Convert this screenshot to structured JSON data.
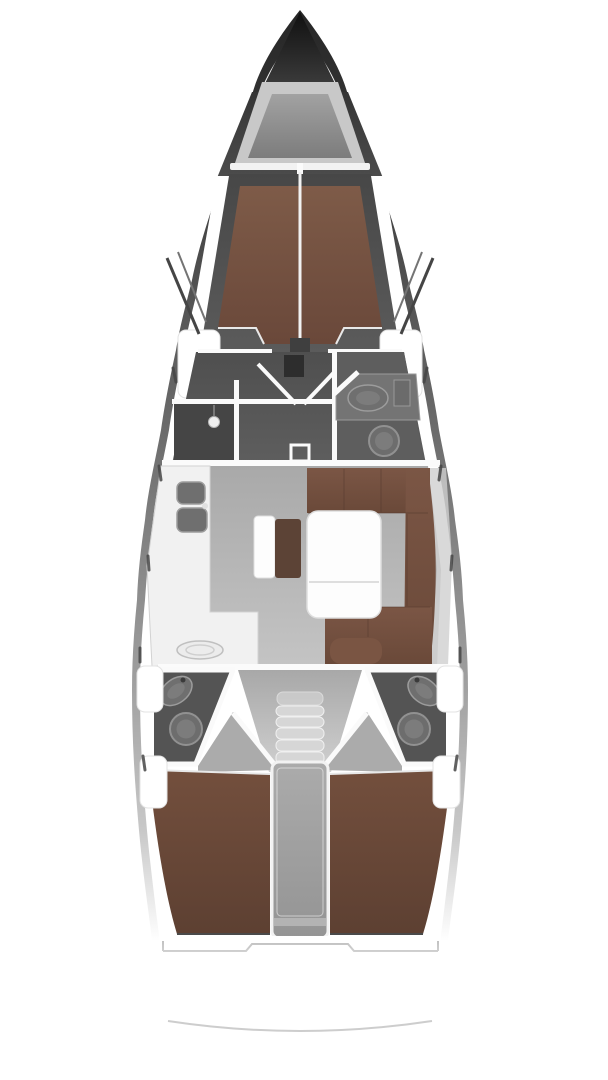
{
  "meta": {
    "title": "Sailing yacht interior layout plan",
    "view": "top-down deck plan",
    "canvas": {
      "width": 608,
      "height": 1080
    },
    "cabins_shown": 3,
    "wet_rooms_shown": 3
  },
  "regions": [
    {
      "id": "anchor-locker",
      "label": "Bow anchor locker"
    },
    {
      "id": "forward-cabin",
      "label": "Forward cabin with V-berth double bed"
    },
    {
      "id": "forward-shower",
      "label": "Forward shower compartment with shower head"
    },
    {
      "id": "forward-head",
      "label": "Forward head with vanity sink and toilet"
    },
    {
      "id": "mast-step",
      "label": "Mast step on centerline"
    },
    {
      "id": "passage-doors",
      "label": "Double doors between forward cabin and saloon"
    },
    {
      "id": "galley",
      "label": "Port galley with twin sinks and stove"
    },
    {
      "id": "saloon",
      "label": "Saloon floor"
    },
    {
      "id": "center-bench",
      "label": "Centerline bench seat pair"
    },
    {
      "id": "u-settee",
      "label": "Starboard U-shaped settee"
    },
    {
      "id": "saloon-table",
      "label": "Saloon table"
    },
    {
      "id": "aft-head-port",
      "label": "Port aft head with sink and toilet"
    },
    {
      "id": "aft-head-starboard",
      "label": "Starboard aft head with sink and toilet"
    },
    {
      "id": "companionway",
      "label": "Companionway steps"
    },
    {
      "id": "engine-box",
      "label": "Engine compartment between aft cabins"
    },
    {
      "id": "aft-cabin-port",
      "label": "Port aft cabin double berth"
    },
    {
      "id": "aft-cabin-starboard",
      "label": "Starboard aft cabin double berth"
    },
    {
      "id": "transom",
      "label": "Transom and stern platform arc"
    },
    {
      "id": "shrouds",
      "label": "Shroud chainplates amidships-forward"
    }
  ],
  "colors": {
    "page_bg": "#ffffff",
    "hull_top": "#262626",
    "hull_upper": "#3a3a3a",
    "hull_mid": "#6a6a6a",
    "hull_lower": "#9e9e9e",
    "hull_faint": "#c9c9c9",
    "hull_white": "#ffffff",
    "bow_tip": "#101010",
    "bow_base": "#3a3a3a",
    "deck_white": "#ffffff",
    "deck_soft": "#f8f8f8",
    "locker_frame": "#c8c8c8",
    "locker_top": "#a2a2a2",
    "locker_bottom": "#7c7c7c",
    "cabin_top_a": "#353535",
    "cabin_top_b": "#4c4c4c",
    "cabin_a": "#474747",
    "cabin_b": "#5b5b5b",
    "head_a": "#4f4f4f",
    "head_b": "#5e5e5e",
    "shower_dark": "#454545",
    "berth_fwd_a": "#7e5b48",
    "berth_fwd_b": "#6a483a",
    "berth_aft_a": "#734f3d",
    "berth_aft_b": "#5d4032",
    "settee_a": "#7b5645",
    "settee_b": "#6a4939",
    "settee_seam": "#54392d",
    "cushion": "#7a5543",
    "bench_brown": "#5c4336",
    "floor_a": "#a9a9a9",
    "floor_b": "#c4c4c4",
    "aft_floor_a": "#a8a8a8",
    "aft_floor_b": "#d0d0d0",
    "counter": "#f1f1f1",
    "counter_edge": "#d2d2d2",
    "sink_dark": "#6f6f6f",
    "sink_rim": "#9c9c9c",
    "fixture": "#6d6d6d",
    "fixture_rim": "#919191",
    "fixture_inner": "#7c7c7c",
    "wall": "#fafafa",
    "bulkhead": "#fbfbfb",
    "table": "#fdfdfd",
    "table_edge": "#dedede",
    "mast": "#2d2d2d",
    "notch": "#3f3f3f",
    "steps": "#d6d6d6",
    "steps_edge": "#f0f0f0",
    "engine_a": "#ababab",
    "engine_b": "#949494",
    "engine_edge": "#f2f2f2",
    "transom_line": "#b9b9b9",
    "stern_arc": "#cdcdcd",
    "shroud": "#454545",
    "shroud_light": "#747474",
    "seam_white": "#f2f2f2",
    "trim_white": "#e8e8e8",
    "panel_white": "#ffffff",
    "panel_edge": "#e3e3e3",
    "shelf_gray": "#cfcfcf",
    "berth_shadow": "#4a4a4a",
    "entry_floor": "#ababab"
  }
}
